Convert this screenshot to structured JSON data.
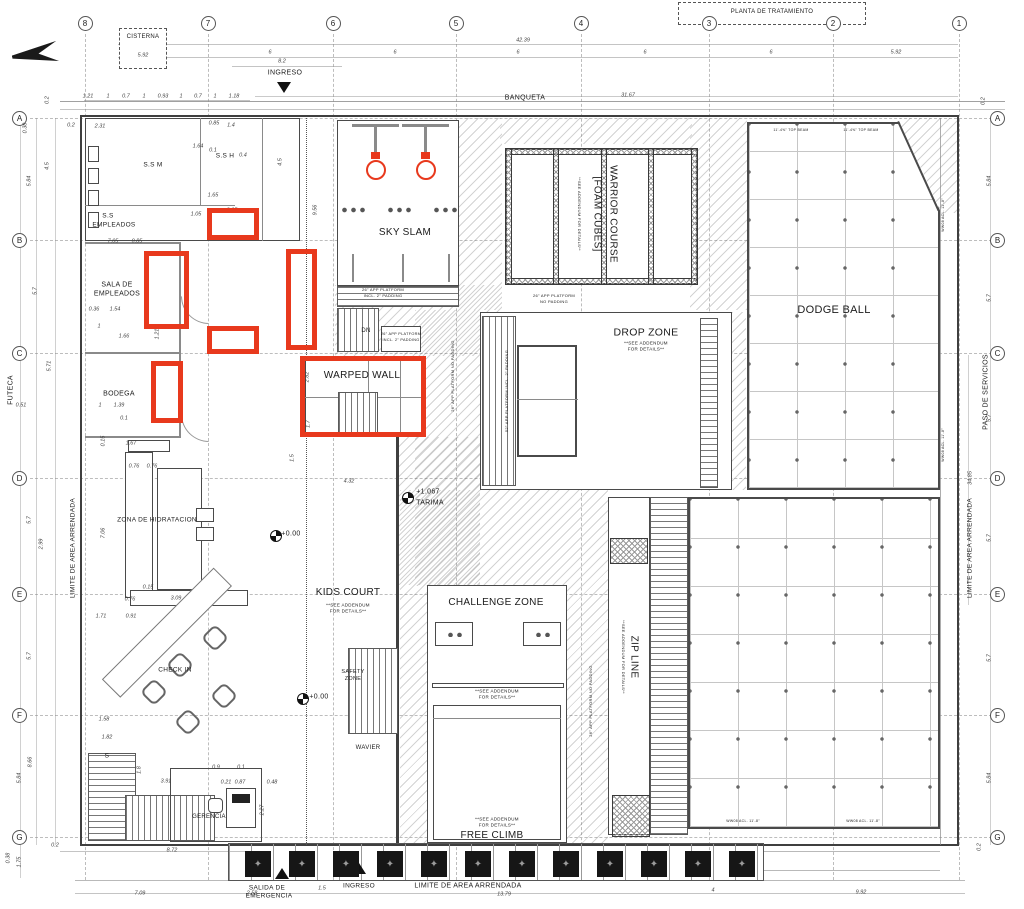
{
  "colors": {
    "highlight": "#e8391d",
    "wall": "#3f3f3f",
    "grid_line": "#bdbdbd"
  },
  "grid": {
    "cols": [
      {
        "n": "8",
        "x": 85
      },
      {
        "n": "7",
        "x": 208
      },
      {
        "n": "6",
        "x": 333
      },
      {
        "n": "5",
        "x": 456
      },
      {
        "n": "4",
        "x": 581
      },
      {
        "n": "3",
        "x": 709
      },
      {
        "n": "2",
        "x": 833
      },
      {
        "n": "1",
        "x": 959
      }
    ],
    "rows": [
      {
        "n": "A",
        "y": 118
      },
      {
        "n": "B",
        "y": 240
      },
      {
        "n": "C",
        "y": 353
      },
      {
        "n": "D",
        "y": 478
      },
      {
        "n": "E",
        "y": 594
      },
      {
        "n": "F",
        "y": 715
      },
      {
        "n": "G",
        "y": 837
      }
    ]
  },
  "labels": [
    {
      "t": "CISTERNA",
      "x": 143,
      "y": 37,
      "s": 6,
      "n": "cisterna-label"
    },
    {
      "t": "PLANTA DE TRATAMIENTO",
      "x": 772,
      "y": 12,
      "s": 6,
      "n": "planta-tratamiento-label"
    },
    {
      "t": "INGRESO",
      "x": 285,
      "y": 73,
      "s": 7,
      "n": "ingreso-top-label"
    },
    {
      "t": "BANQUETA",
      "x": 525,
      "y": 98,
      "s": 7,
      "n": "banqueta-label"
    },
    {
      "t": "S.S M",
      "x": 153,
      "y": 166,
      "s": 6.5,
      "n": "ss-m-label"
    },
    {
      "t": "S.S H",
      "x": 225,
      "y": 157,
      "s": 6.5,
      "n": "ss-h-label"
    },
    {
      "t": "S.S",
      "x": 108,
      "y": 217,
      "s": 6.5,
      "n": "ss-empleados-label"
    },
    {
      "t": "EMPLEADOS",
      "x": 114,
      "y": 226,
      "s": 6.5
    },
    {
      "t": "SALA DE",
      "x": 117,
      "y": 285,
      "s": 7,
      "n": "sala-empleados-label"
    },
    {
      "t": "EMPLEADOS",
      "x": 117,
      "y": 294,
      "s": 7
    },
    {
      "t": "BODEGA",
      "x": 119,
      "y": 394,
      "s": 7,
      "n": "bodega-label"
    },
    {
      "t": "ZONA DE HIDRATACION",
      "x": 157,
      "y": 521,
      "s": 6.5,
      "n": "zona-hidratacion-label"
    },
    {
      "t": "CHECK IN",
      "x": 175,
      "y": 671,
      "s": 6.5,
      "n": "check-in-label"
    },
    {
      "t": "GERENCIA",
      "x": 209,
      "y": 817,
      "s": 6,
      "n": "gerencia-label"
    },
    {
      "t": "S",
      "x": 107,
      "y": 757,
      "s": 6.5
    },
    {
      "t": "SKY SLAM",
      "x": 405,
      "y": 233,
      "s": 10,
      "n": "sky-slam-label"
    },
    {
      "t": "WARPED WALL",
      "x": 362,
      "y": 376,
      "s": 10,
      "n": "warped-wall-label"
    },
    {
      "t": "WARRIOR COURSE",
      "x": 612,
      "y": 214,
      "s": 10,
      "r": 90,
      "n": "warrior-course-label"
    },
    {
      "t": "[FOAM CUBES]",
      "x": 596,
      "y": 214,
      "s": 10,
      "r": 90
    },
    {
      "t": "**SEE ADDENDUM FOR DETAILS**",
      "x": 579,
      "y": 214,
      "s": 4,
      "r": 90
    },
    {
      "t": "DROP ZONE",
      "x": 646,
      "y": 333,
      "s": 10.5,
      "n": "drop-zone-label"
    },
    {
      "t": "**SEE ADDENDUM",
      "x": 646,
      "y": 344,
      "s": 4.5
    },
    {
      "t": "FOR DETAILS**",
      "x": 646,
      "y": 350,
      "s": 4.5
    },
    {
      "t": "DODGE BALL",
      "x": 834,
      "y": 311,
      "s": 11,
      "n": "dodge-ball-label"
    },
    {
      "t": "KIDS COURT",
      "x": 348,
      "y": 593,
      "s": 10,
      "n": "kids-court-label"
    },
    {
      "t": "**SEE ADDENDUM",
      "x": 348,
      "y": 606,
      "s": 4.5
    },
    {
      "t": "FOR DETAILS**",
      "x": 348,
      "y": 612,
      "s": 4.5
    },
    {
      "t": "CHALLENGE ZONE",
      "x": 496,
      "y": 603,
      "s": 10,
      "n": "challenge-zone-label"
    },
    {
      "t": "**SEE ADDENDUM",
      "x": 497,
      "y": 692,
      "s": 4.5
    },
    {
      "t": "FOR DETAILS**",
      "x": 497,
      "y": 698,
      "s": 4.5
    },
    {
      "t": "**SEE ADDENDUM",
      "x": 497,
      "y": 820,
      "s": 4.5
    },
    {
      "t": "FOR DETAILS**",
      "x": 497,
      "y": 826,
      "s": 4.5
    },
    {
      "t": "FREE CLIMB",
      "x": 492,
      "y": 836,
      "s": 10,
      "n": "free-climb-label"
    },
    {
      "t": "SAFETY",
      "x": 353,
      "y": 673,
      "s": 5.5,
      "n": "safety-zone-label"
    },
    {
      "t": "ZONE",
      "x": 353,
      "y": 680,
      "s": 5.5
    },
    {
      "t": "WAVIER",
      "x": 368,
      "y": 748,
      "s": 6,
      "n": "wavier-label"
    },
    {
      "t": "ZIP LINE",
      "x": 633,
      "y": 657,
      "s": 10,
      "r": 90,
      "n": "zip-line-label"
    },
    {
      "t": "**SEE ADDENDUM FOR DETAILS**",
      "x": 623,
      "y": 657,
      "s": 4,
      "r": 90
    },
    {
      "t": "+1.067",
      "x": 428,
      "y": 492,
      "s": 7,
      "n": "tarima-level-label"
    },
    {
      "t": "TARIMA",
      "x": 430,
      "y": 503,
      "s": 7
    },
    {
      "t": "+0.00",
      "x": 291,
      "y": 534,
      "s": 7,
      "n": "level-zero-label"
    },
    {
      "t": "+0.00",
      "x": 319,
      "y": 697,
      "s": 7,
      "n": "level-zero-label"
    },
    {
      "t": "DN",
      "x": 366,
      "y": 331,
      "s": 6,
      "n": "stair-dn-label"
    },
    {
      "t": "FUTECA",
      "x": 11,
      "y": 390,
      "s": 7,
      "r": -90,
      "n": "futeca-label"
    },
    {
      "t": "PASO DE SERVICIOS",
      "x": 986,
      "y": 392,
      "s": 7,
      "r": -90,
      "n": "paso-servicios-label"
    },
    {
      "t": "LIMITE DE AREA ARRENDADA",
      "x": 971,
      "y": 548,
      "s": 6.5,
      "r": -90,
      "n": "limite-right-label"
    },
    {
      "t": "LIMITE DE AREA ARRENDADA",
      "x": 74,
      "y": 548,
      "s": 6.5,
      "r": -90,
      "n": "limite-left-label"
    },
    {
      "t": "LIMITE DE AREA ARRENDADA",
      "x": 468,
      "y": 886,
      "s": 7,
      "n": "limite-bottom-label"
    },
    {
      "t": "SALIDA DE",
      "x": 267,
      "y": 889,
      "s": 6.5,
      "n": "salida-emergencia-label"
    },
    {
      "t": "EMERGENCIA",
      "x": 269,
      "y": 897,
      "s": 6.5
    },
    {
      "t": "INGRESO",
      "x": 359,
      "y": 887,
      "s": 6.5,
      "n": "ingreso-bottom-label"
    },
    {
      "t": "11'-4⅝\" TOP BEAM",
      "x": 791,
      "y": 131,
      "s": 3.5
    },
    {
      "t": "11'-4⅝\" TOP BEAM",
      "x": 861,
      "y": 131,
      "s": 3.5
    },
    {
      "t": "26\" APP PLATFORM",
      "x": 383,
      "y": 290,
      "s": 4
    },
    {
      "t": "INCL. 2\" PADDING",
      "x": 383,
      "y": 296,
      "s": 4
    },
    {
      "t": "26\" APP PLATFORM",
      "x": 401,
      "y": 334,
      "s": 3.8
    },
    {
      "t": "INCL. 2\" PADDING",
      "x": 401,
      "y": 340,
      "s": 3.8
    },
    {
      "t": "26\" APP PLATFORM",
      "x": 554,
      "y": 296,
      "s": 4
    },
    {
      "t": "NO PADDING",
      "x": 554,
      "y": 302,
      "s": 4
    },
    {
      "t": "26\" APP PLATFORM NO PADDING",
      "x": 453,
      "y": 376,
      "s": 4,
      "r": -90
    },
    {
      "t": "52\" APP PLATFORM INCL. 2\" PADDING",
      "x": 507,
      "y": 391,
      "s": 4,
      "r": -90
    },
    {
      "t": "26\" APP PLATFORM NO PADDING",
      "x": 591,
      "y": 701,
      "s": 4,
      "r": -90
    },
    {
      "t": "WW08 ACL. 11'-8\"",
      "x": 743,
      "y": 822,
      "s": 3.5
    },
    {
      "t": "WW08 ACL. 11'-8\"",
      "x": 863,
      "y": 822,
      "s": 3.5
    },
    {
      "t": "WW08 ACL. 11'-8\"",
      "x": 944,
      "y": 215,
      "s": 3.5,
      "r": -90
    },
    {
      "t": "WW08 ACL. 11'-8\"",
      "x": 944,
      "y": 445,
      "s": 3.5,
      "r": -90
    }
  ],
  "dims": [
    [
      "42.39",
      523,
      41
    ],
    [
      "6",
      270,
      53
    ],
    [
      "6",
      395,
      53
    ],
    [
      "6",
      518,
      53
    ],
    [
      "6",
      645,
      53
    ],
    [
      "6",
      771,
      53
    ],
    [
      "5.92",
      896,
      53
    ],
    [
      "5.92",
      143,
      56
    ],
    [
      "8.2",
      282,
      62
    ],
    [
      "31.67",
      628,
      96
    ],
    [
      "1.21",
      88,
      97
    ],
    [
      "1",
      108,
      97
    ],
    [
      "0.7",
      126,
      97
    ],
    [
      "1",
      144,
      97
    ],
    [
      "0.93",
      163,
      97
    ],
    [
      "1",
      181,
      97
    ],
    [
      "0.7",
      198,
      97
    ],
    [
      "1",
      215,
      97
    ],
    [
      "1.18",
      234,
      97
    ],
    [
      "0.2",
      48,
      100,
      1
    ],
    [
      "0.38",
      26,
      128,
      1
    ],
    [
      "4.5",
      48,
      166,
      1
    ],
    [
      "5.84",
      30,
      181,
      1
    ],
    [
      "5.7",
      36,
      291,
      1
    ],
    [
      "5.71",
      50,
      366,
      1
    ],
    [
      "5.7",
      30,
      520,
      1
    ],
    [
      "2.99",
      42,
      544,
      1
    ],
    [
      "5.7",
      30,
      656,
      1
    ],
    [
      "8.66",
      31,
      762,
      1
    ],
    [
      "5.84",
      20,
      778,
      1
    ],
    [
      "0.2",
      71,
      126
    ],
    [
      "2.31",
      100,
      127
    ],
    [
      "0.85",
      214,
      124
    ],
    [
      "1.4",
      231,
      126
    ],
    [
      "1.64",
      198,
      147
    ],
    [
      "0.1",
      213,
      151
    ],
    [
      "0.4",
      243,
      156
    ],
    [
      "4.5",
      281,
      162,
      1
    ],
    [
      "1.65",
      213,
      196
    ],
    [
      "1.05",
      196,
      215
    ],
    [
      "3.05",
      232,
      211
    ],
    [
      "9.56",
      316,
      210,
      1
    ],
    [
      "7.05",
      113,
      242
    ],
    [
      "0.85",
      137,
      242
    ],
    [
      "0.36",
      94,
      310
    ],
    [
      "1.54",
      115,
      310
    ],
    [
      "1",
      99,
      327
    ],
    [
      "1.66",
      124,
      337
    ],
    [
      "1.21",
      158,
      334,
      1
    ],
    [
      "0.51",
      21,
      406
    ],
    [
      "1",
      100,
      406
    ],
    [
      "1.39",
      119,
      406
    ],
    [
      "0.1",
      124,
      419
    ],
    [
      "0.15",
      104,
      441,
      1
    ],
    [
      "1.67",
      131,
      444
    ],
    [
      "0.76",
      134,
      467
    ],
    [
      "0.76",
      152,
      467
    ],
    [
      "7.06",
      104,
      533,
      1
    ],
    [
      "0.15",
      148,
      588
    ],
    [
      "0.76",
      130,
      600
    ],
    [
      "3.09",
      176,
      599
    ],
    [
      "1.71",
      101,
      617
    ],
    [
      "0.91",
      131,
      617
    ],
    [
      "1.5",
      293,
      458,
      1
    ],
    [
      "4.32",
      349,
      482
    ],
    [
      "2.82",
      308,
      377,
      1
    ],
    [
      "1.7",
      309,
      424,
      1
    ],
    [
      "1.58",
      104,
      720
    ],
    [
      "1.82",
      107,
      738
    ],
    [
      "1.8",
      140,
      770,
      1
    ],
    [
      "3.91",
      166,
      782
    ],
    [
      "0.9",
      216,
      768
    ],
    [
      "0.1",
      241,
      768
    ],
    [
      "0.21",
      226,
      783
    ],
    [
      "0.87",
      240,
      783
    ],
    [
      "0.48",
      272,
      783
    ],
    [
      "2.27",
      263,
      810,
      1
    ],
    [
      "0.2",
      55,
      846
    ],
    [
      "0.38",
      9,
      858,
      1
    ],
    [
      "1.75",
      20,
      862,
      1
    ],
    [
      "8.72",
      172,
      851
    ],
    [
      "7.09",
      140,
      894
    ],
    [
      "2.58",
      252,
      894
    ],
    [
      "1.5",
      322,
      889
    ],
    [
      "13.79",
      504,
      895
    ],
    [
      "4",
      713,
      891
    ],
    [
      "9.92",
      861,
      893
    ],
    [
      "0.2",
      980,
      847,
      1
    ],
    [
      "0.2",
      984,
      101,
      1
    ],
    [
      "5.84",
      990,
      181,
      1
    ],
    [
      "5.7",
      990,
      298,
      1
    ],
    [
      "5.7",
      990,
      418,
      1
    ],
    [
      "34.85",
      971,
      478,
      1
    ],
    [
      "5.7",
      990,
      538,
      1
    ],
    [
      "5.7",
      990,
      658,
      1
    ],
    [
      "5.84",
      990,
      778,
      1
    ]
  ],
  "highlights": [
    {
      "x": 207,
      "y": 208,
      "w": 52,
      "h": 32
    },
    {
      "x": 144,
      "y": 251,
      "w": 45,
      "h": 78
    },
    {
      "x": 286,
      "y": 249,
      "w": 31,
      "h": 101
    },
    {
      "x": 207,
      "y": 326,
      "w": 52,
      "h": 28
    },
    {
      "x": 151,
      "y": 361,
      "w": 32,
      "h": 62
    },
    {
      "x": 300,
      "y": 356,
      "w": 126,
      "h": 81
    }
  ],
  "planters": {
    "y": 851,
    "size": 26,
    "glyph": "✦",
    "xs": [
      245,
      289,
      333,
      377,
      421,
      465,
      509,
      553,
      597,
      641,
      685,
      729
    ]
  }
}
